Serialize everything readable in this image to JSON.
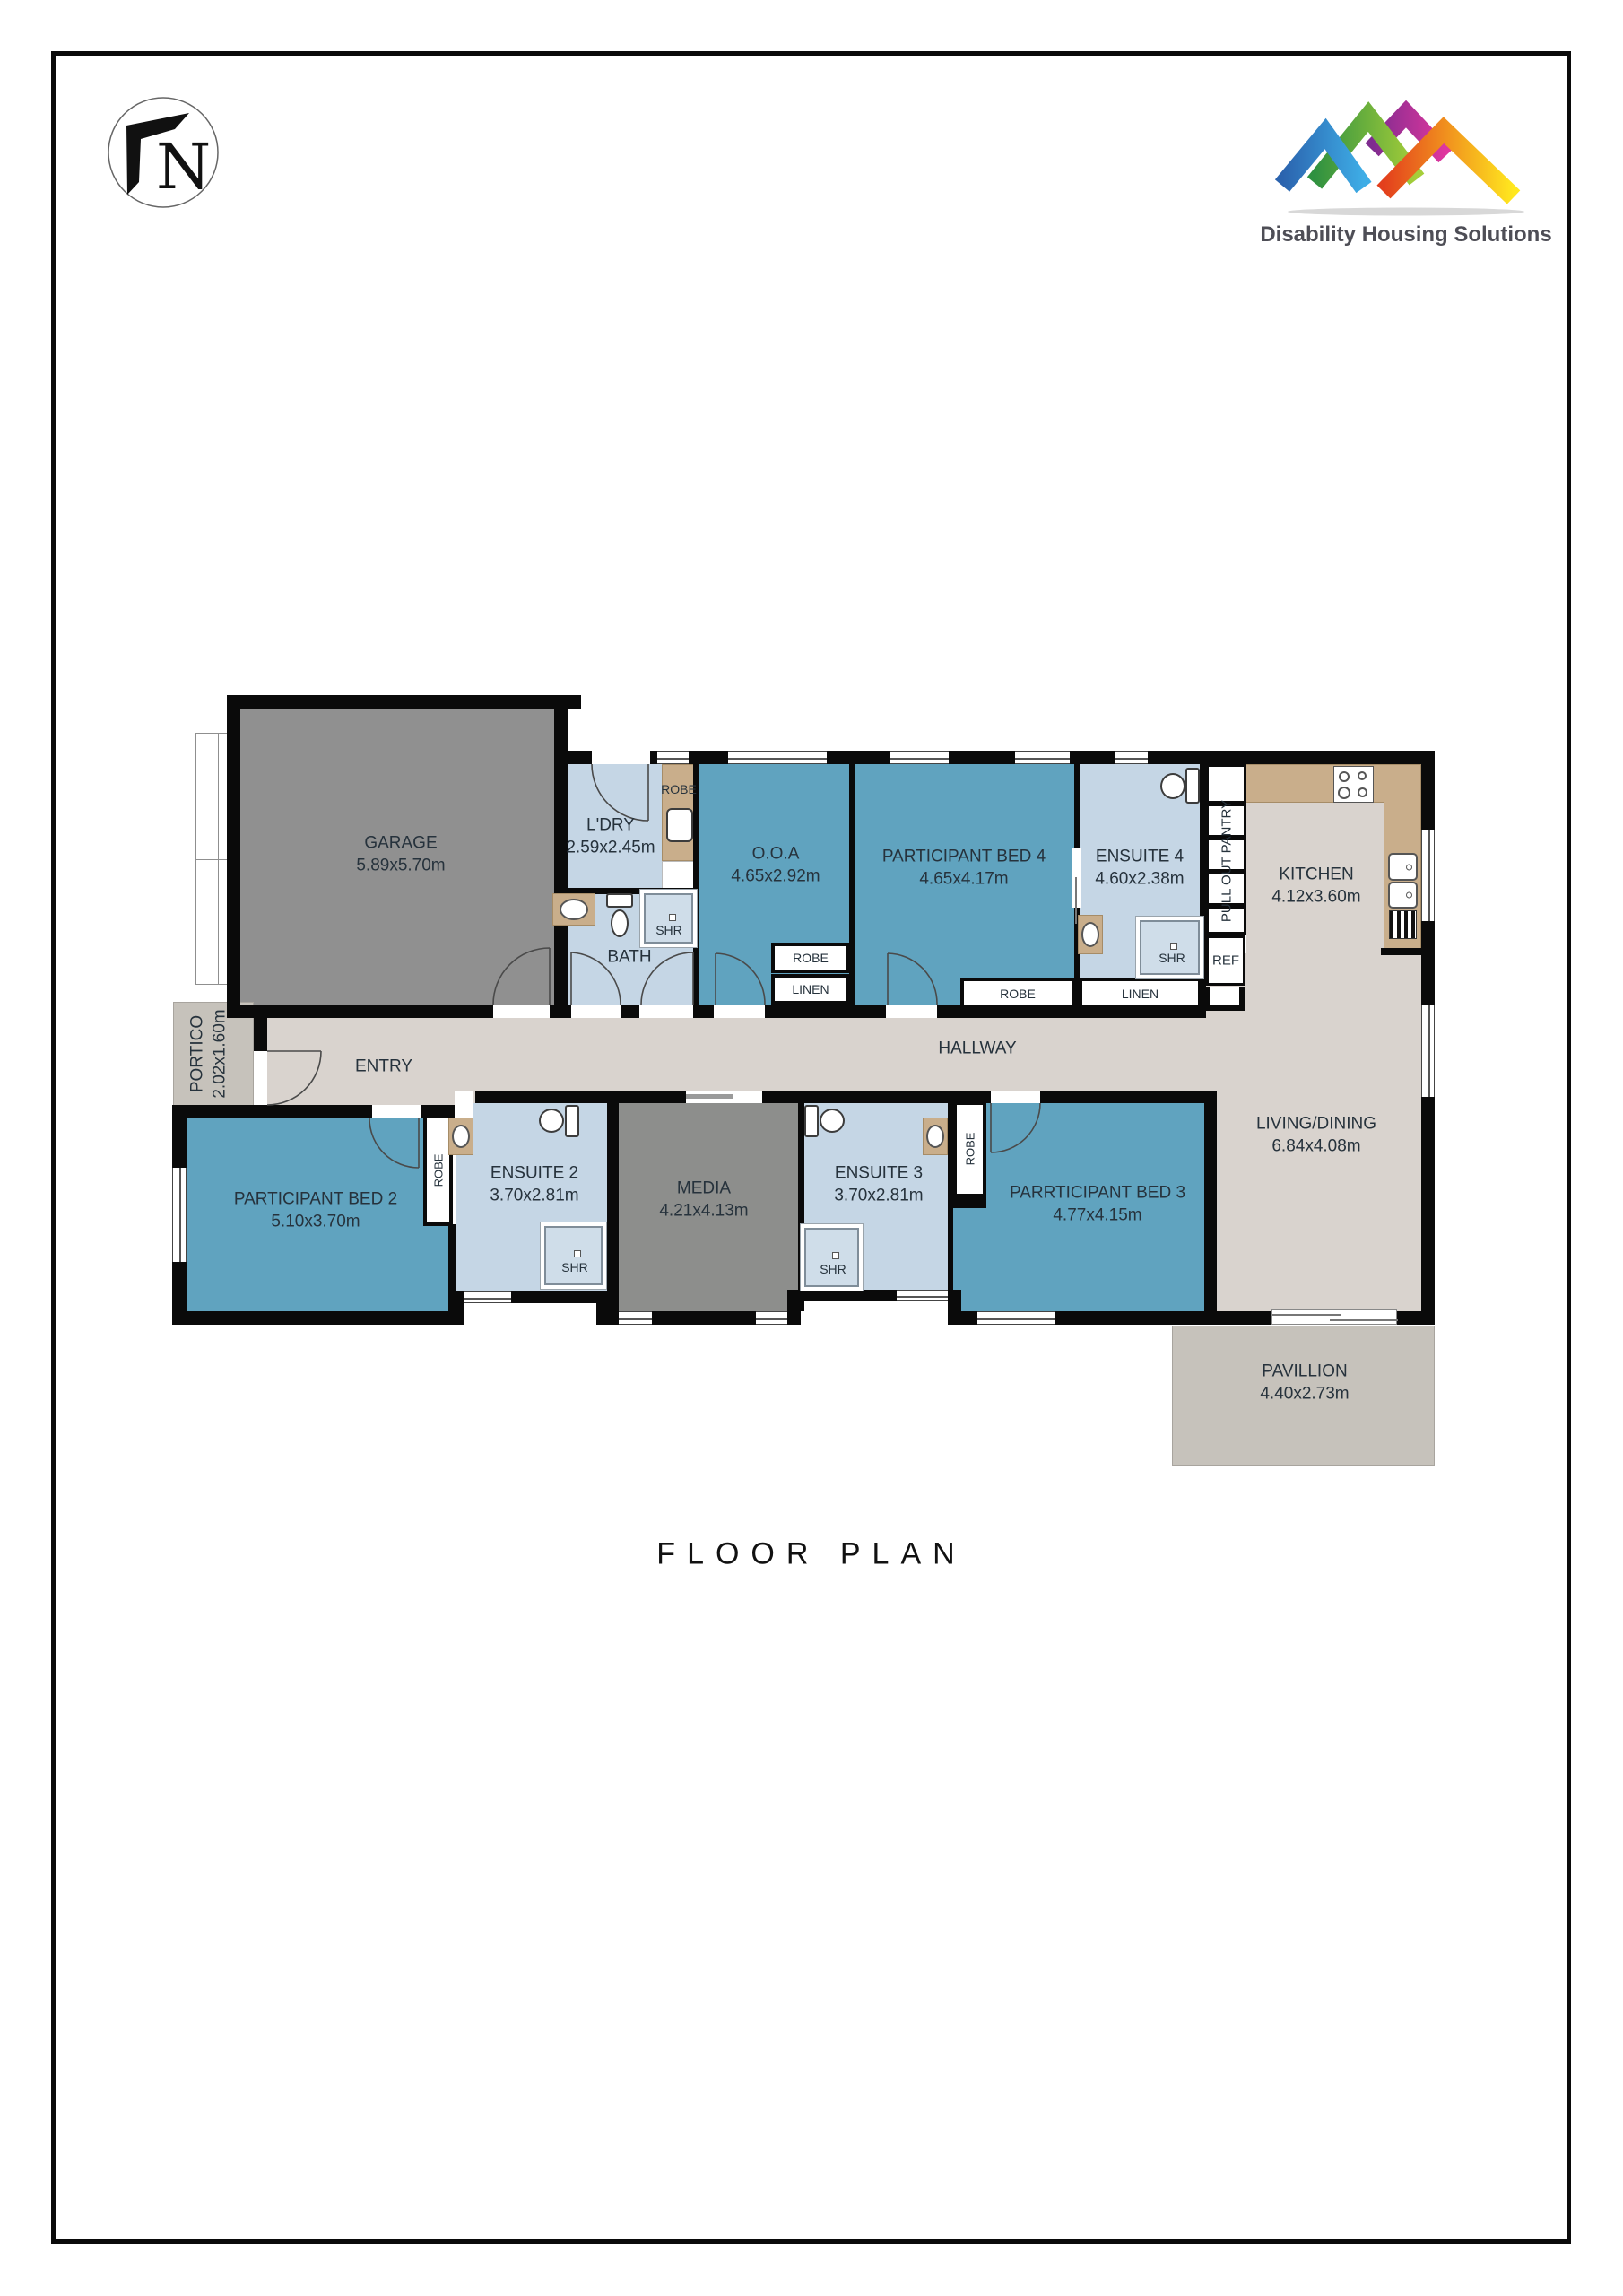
{
  "heading": "FLOOR PLAN",
  "north_badge": {
    "letter": "N"
  },
  "logo": {
    "text": "Disability Housing Solutions",
    "colors": {
      "blue": "#2b63ae",
      "green": "#2f9140",
      "magenta": "#7e2c8f",
      "orange": "#e33f1d",
      "yellow": "#ffe81f",
      "text": "#4e4e56"
    }
  },
  "palette": {
    "room_blue": "#60a3bf",
    "room_lightblue": "#c5d6e5",
    "room_gray": "#909090",
    "floor_beige": "#d9d3ce",
    "outdoor_gray": "#c6c2bb",
    "bench_tan": "#c9ae8b",
    "wall": "#0a0a0a"
  },
  "rooms": {
    "garage": {
      "name": "GARAGE",
      "dims": "5.89x5.70m"
    },
    "ldry": {
      "name": "L'DRY",
      "dims": "2.59x2.45m"
    },
    "ooa": {
      "name": "O.O.A",
      "dims": "4.65x2.92m"
    },
    "bed4": {
      "name": "PARTICIPANT BED 4",
      "dims": "4.65x4.17m"
    },
    "ensuite4": {
      "name": "ENSUITE 4",
      "dims": "4.60x2.38m"
    },
    "kitchen": {
      "name": "KITCHEN",
      "dims": "4.12x3.60m"
    },
    "bath": {
      "name": "BATH"
    },
    "hallway": {
      "name": "HALLWAY"
    },
    "entry": {
      "name": "ENTRY"
    },
    "portico": {
      "name": "PORTICO",
      "dims": "2.02x1.60m"
    },
    "bed2": {
      "name": "PARTICIPANT BED 2",
      "dims": "5.10x3.70m"
    },
    "ensuite2": {
      "name": "ENSUITE 2",
      "dims": "3.70x2.81m"
    },
    "media": {
      "name": "MEDIA",
      "dims": "4.21x4.13m"
    },
    "ensuite3": {
      "name": "ENSUITE 3",
      "dims": "3.70x2.81m"
    },
    "bed3": {
      "name": "PARRTICIPANT BED 3",
      "dims": "4.77x4.15m"
    },
    "living": {
      "name": "LIVING/DINING",
      "dims": "6.84x4.08m"
    },
    "pavillion": {
      "name": "PAVILLION",
      "dims": "4.40x2.73m"
    }
  },
  "fixtures": {
    "robe": "ROBE",
    "linen": "LINEN",
    "shr": "SHR",
    "ref": "REF",
    "pantry": "PULL OUT PANTRY"
  }
}
